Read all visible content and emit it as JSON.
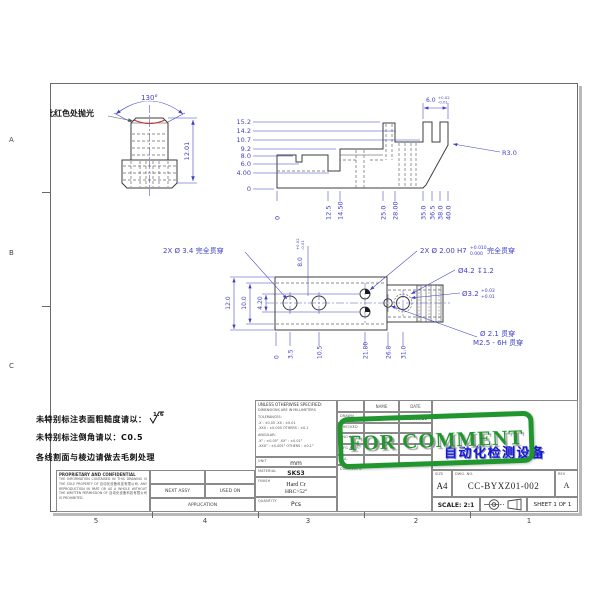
{
  "zones": {
    "left": [
      "A",
      "B",
      "C"
    ],
    "bottom": [
      "5",
      "4",
      "3",
      "2",
      "1"
    ]
  },
  "views": {
    "front": {
      "angle": "130°",
      "height": "12.01",
      "polish_note": "此红色处抛光"
    },
    "side": {
      "left_ordinates": [
        "15.2",
        "14.2",
        "10.7",
        "9.2",
        "8.0",
        "6.0",
        "4.00",
        "0"
      ],
      "bottom_ordinates": [
        "0",
        "12.5",
        "14.50",
        "25.0",
        "28.00",
        "35.0",
        "36.5",
        "38.0",
        "40.0"
      ],
      "width": "6.0",
      "width_tol_up": "+0.02",
      "width_tol_lo": "-0.01",
      "radius": "R3.0"
    },
    "plan": {
      "dim_12": "12.0",
      "dim_10": "10.0",
      "dim_420": "4.20",
      "ord_8": "8.0",
      "ord_8_tol_up": "+0.02",
      "ord_8_tol_lo": "-0.01",
      "bottom_ordinates": [
        "0",
        "3.5",
        "10.5",
        "21.80",
        "26.8",
        "31.0"
      ],
      "label_34": "2X Ø 3.4 完全贯穿",
      "label_200": "2X Ø 2.00 H7",
      "label_200_tol_up": "+0.010",
      "label_200_tol_lo": "0.000",
      "label_200_suffix": "完全贯穿",
      "label_cbore": "Ø4.2 ↧1.2",
      "label_32": "Ø3.2",
      "label_32_tol_up": "+0.03",
      "label_32_tol_lo": "+0.01",
      "label_thread1": "Ø 2.1 贯穿",
      "label_thread2": "M2.5 - 6H 贯穿"
    }
  },
  "notes": {
    "line1": "未特别标注表面粗糙度请以：",
    "roughness": "1.6",
    "line2": "未特别标注倒角请以：C0.5",
    "line3": "各线割面与棱边请做去毛刺处理"
  },
  "title_block": {
    "unless": "UNLESS OTHERWISE SPECIFIED:",
    "dims_in": "DIMENSIONS ARE IN MILLIMETERS",
    "tolerances_label": "TOLERANCES:",
    "tol_line1": ".X : ±0.05      .XX : ±0.01",
    "tol_line2": ".XXX : ±0.005   OTHERS : ±0.1",
    "angular_label": "ANGULAR:",
    "ang_line1": ".X° : ±0.05°     .XX° : ±0.01°",
    "ang_line2": ".XXX° : ±0.005°  OTHERS : ±0.1°",
    "unit_label": "UNIT",
    "unit_value": "mm",
    "material_label": "MATERIAL",
    "material_value": "SKS3",
    "finish_label": "FINISH",
    "finish_value1": "Hard Cr",
    "finish_value2": "HRC>52°",
    "quantity_label": "QUANTITY",
    "quantity_value": "Pcs",
    "name_col": "NAME",
    "date_col": "DATE",
    "rows": [
      {
        "label": "DRAWN",
        "name": "XXX",
        "date": "2019/09/26"
      },
      {
        "label": "CHECKED",
        "name": "",
        "date": ""
      },
      {
        "label": "ENG APPR.",
        "name": "",
        "date": ""
      },
      {
        "label": "MFG APPR.",
        "name": "",
        "date": ""
      },
      {
        "label": "Q.A.",
        "name": "",
        "date": ""
      }
    ],
    "comments_label": "COMMENTS:",
    "size_label": "SIZE",
    "size_value": "A4",
    "dwg_label": "DWG. NO.",
    "dwg_value": "CC-BYXZ01-002",
    "rev_label": "REV",
    "rev_value": "A",
    "scale": "SCALE: 2:1",
    "sheet": "SHEET 1 OF 1",
    "title_value": "自动化检测设备",
    "proprietary_title": "PROPRIETARY AND CONFIDENTIAL",
    "proprietary_body": "THE INFORMATION CONTAINED IN THIS DRAWING IS THE SOLE PROPERTY OF 自动化设备科技有限公司. ANY REPRODUCTION IN PART OR AS A WHOLE WITHOUT THE WRITTEN PERMISSION OF 自动化设备科技有限公司 IS PROHIBITED.",
    "next_assy": "NEXT ASSY",
    "used_on": "USED ON",
    "application": "APPLICATION"
  },
  "stamp": {
    "text": "FOR COMMENT",
    "color": "#21962f"
  }
}
